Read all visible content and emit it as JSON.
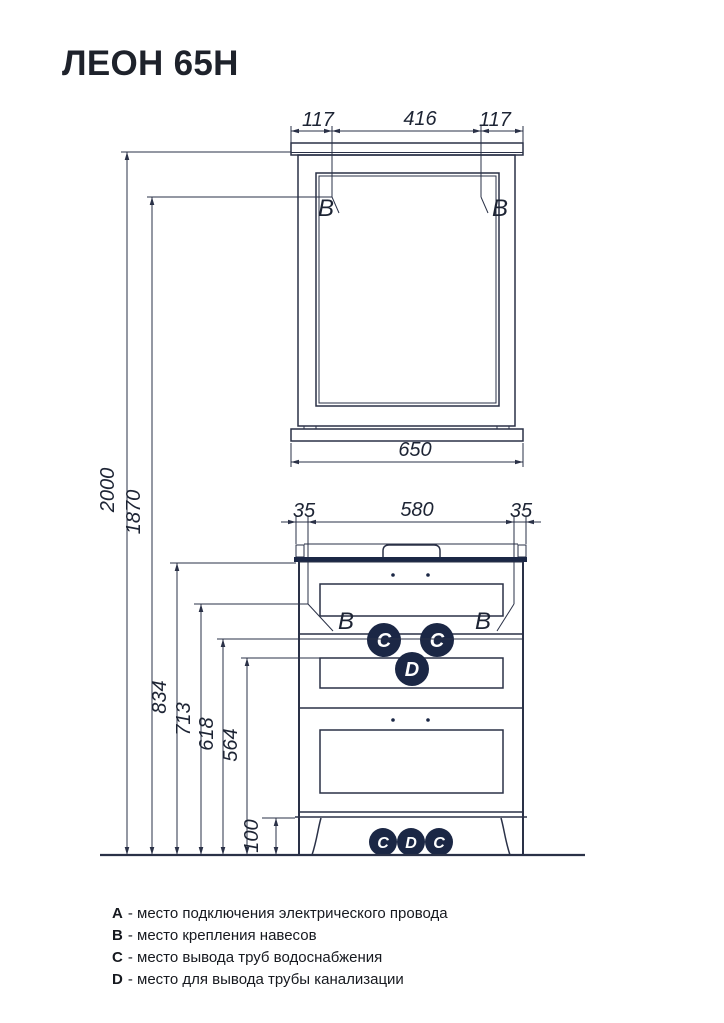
{
  "title": "ЛЕОН 65Н",
  "colors": {
    "ink": "#2a3147",
    "text": "#1d2434",
    "marker_fill": "#1b2745",
    "background": "#ffffff"
  },
  "dims": {
    "mirror_side_offset": "117",
    "mirror_mount_span": "416",
    "mirror_width": "650",
    "cabinet_side_offset": "35",
    "cabinet_mount_span": "580",
    "total_height": "2000",
    "mirror_mount_height": "1870",
    "cabinet_height": "834",
    "cabinet_mount_height": "713",
    "water_outlet_height": "618",
    "drain_outlet_height": "564",
    "plinth_height": "100"
  },
  "markers": {
    "electric": "A",
    "mount": "B",
    "water": "C",
    "drain": "D"
  },
  "legend": [
    {
      "key": "A",
      "desc": "- место подключения электрического провода"
    },
    {
      "key": "B",
      "desc": "- место крепления навесов"
    },
    {
      "key": "C",
      "desc": "- место вывода труб водоснабжения"
    },
    {
      "key": "D",
      "desc": "- место для вывода трубы канализации"
    }
  ]
}
